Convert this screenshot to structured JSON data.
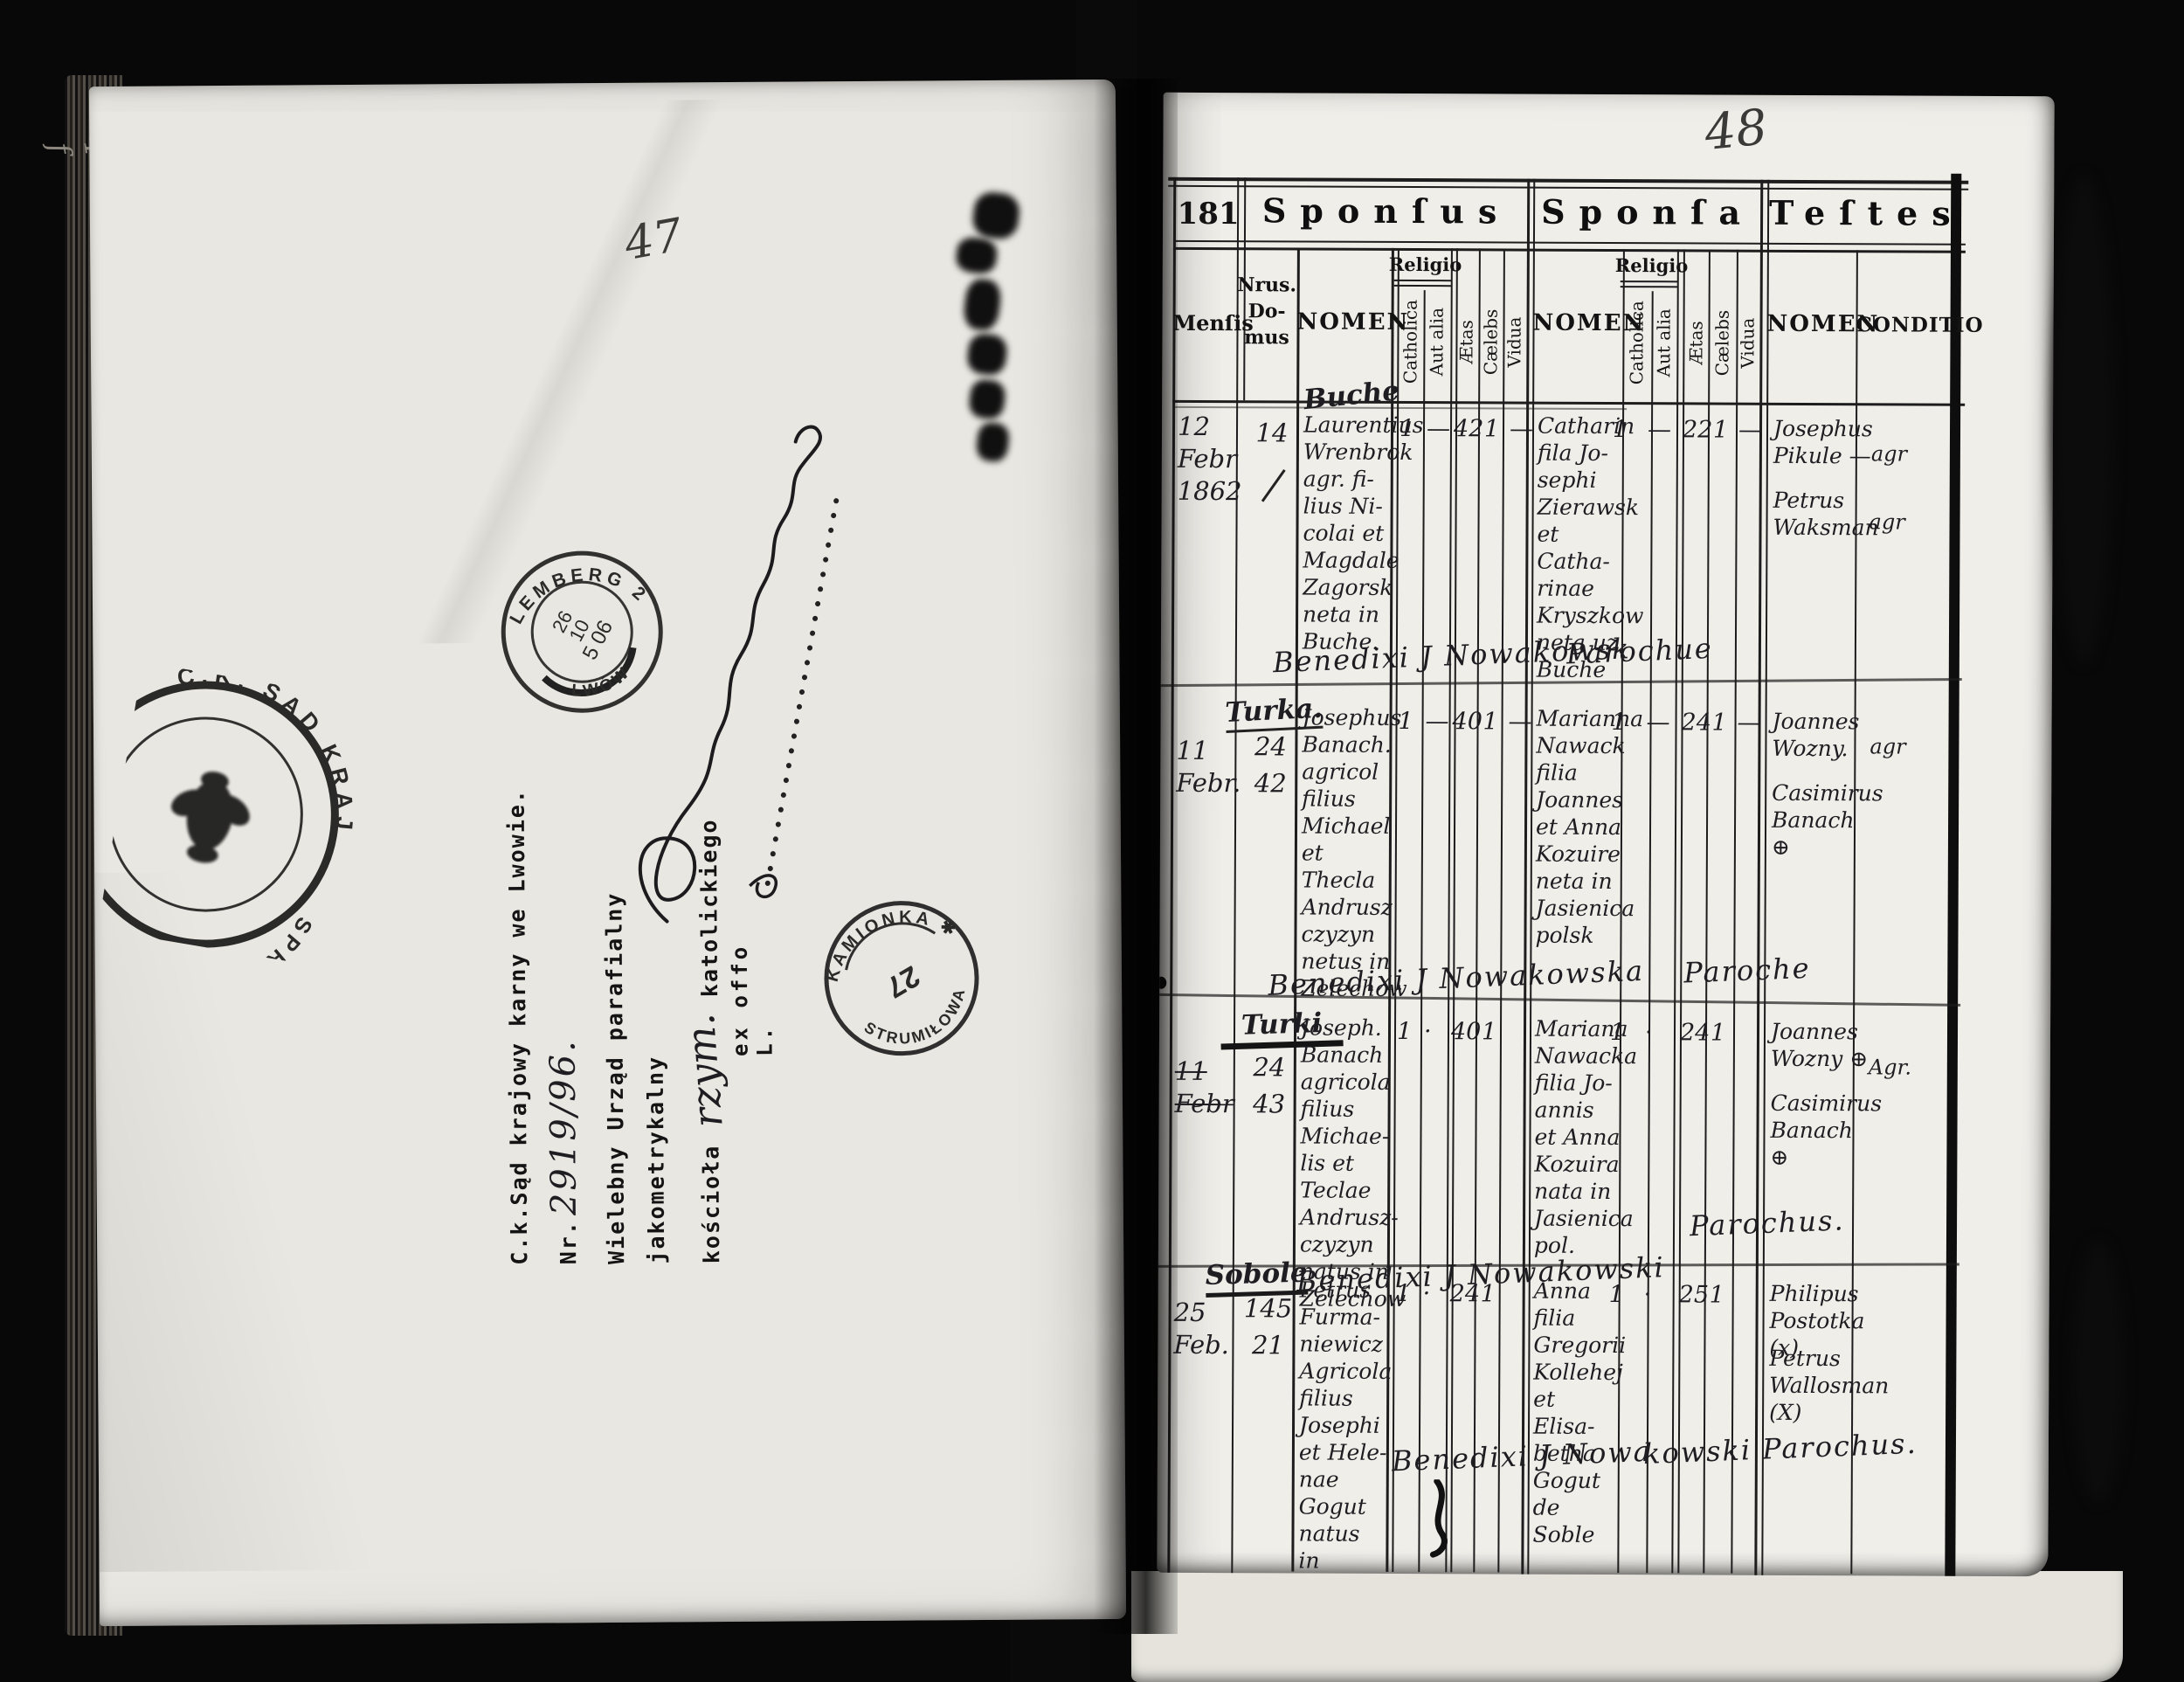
{
  "annotations": {
    "left_page_number": "47",
    "right_page_number": "48",
    "edge_mark": "4 f",
    "ex_offo": "ex offo L."
  },
  "left_page": {
    "court_letter": {
      "line1": "C.k.Sąd krajowy karny we Lwowie.",
      "line2_prefix": "Nr.",
      "line2_number": "2919/96.",
      "line3": "Wielebny Urząd parafialny jakometrykalny",
      "line4_prefix": "kościoła",
      "line4_inserted": "rzym.",
      "line4_suffix": "katolickiego"
    },
    "stamps": {
      "court_seal_arc_top": "C.K. SĄD KRAJ. W",
      "court_seal_arc_bottom": "SPRAW.",
      "lemberg_top": "LEMBERG 2",
      "lemberg_bottom": "LWÓW",
      "lemberg_date_l1": "26",
      "lemberg_date_l2": "10",
      "lemberg_date_l3": "5 06",
      "kamionka_top": "KAMIONKA ✱",
      "kamionka_bottom": "STRUMIŁOWA",
      "kamionka_center": "27"
    }
  },
  "right_page": {
    "folio": "181",
    "groups": {
      "sponsus": "Sponſus",
      "sponsa": "Sponſa",
      "testes": "Teſtes"
    },
    "columns": {
      "mensis": "Menſis",
      "nrus": "Nrus.\nDo-\nmus",
      "nomen": "NOMEN",
      "religio": "Religio",
      "catholica": "Catholica",
      "aut_alia": "Aut alia",
      "aetas": "Ætas",
      "caelebs": "Cælebs",
      "vidua": "Vidua",
      "nomen_sponsa": "NOMEN",
      "religio_sponsa": "Religio",
      "catholica_sponsa": "Catholica",
      "aut_alia_sponsa": "Aut alia",
      "aetas_sponsa": "Ætas",
      "caelebs_sponsa": "Cælebs",
      "vidua_sponsa": "Vidua",
      "nomen_testes": "NOMEN",
      "conditio": "CONDITIO"
    },
    "entries": [
      {
        "place": "Buche",
        "date": "12\nFebr\n1862",
        "nrus": "14",
        "sponsus": "Laurentius\nWrenbrok\nagr. fi-\nlius Ni-\ncolai et\nMagdale\nZagorsk\nneta in\nBuche.",
        "s_cath": "1",
        "s_aut": "—",
        "s_aetas": "42",
        "s_cael": "1",
        "s_vid": "—",
        "sponsa": "Catharin\nfila Jo-\nsephi\nZierawsk\net Catha-\nrinae\nKryszkow\nneta uz\nBuche",
        "a_cath": "1",
        "a_aut": "—",
        "a_aetas": "22",
        "a_cael": "1",
        "a_vid": "—",
        "testis1": "Josephus\nPikule —",
        "testis1_cond": "agr",
        "testis2": "Petrus\nWaksman",
        "testis2_cond": "agr",
        "bened1": "Benedixi J Nowakowsk",
        "bened2": "Parochue"
      },
      {
        "place": "Turka.",
        "date": "11\nFebr.",
        "nrus": "24\n42",
        "sponsus": "Josephus\nBanach.\nagricol\nfilius\nMichael\net Thecla\nAndrusz\nczyzyn\nnetus in\nZelechow",
        "s_cath": "1",
        "s_aut": "—",
        "s_aetas": "40",
        "s_cael": "1",
        "s_vid": "—",
        "sponsa": "Marianna\nNawack\nfilia\nJoannes\net Anna\nKozuire\nneta in\nJasienica\npolsk",
        "a_cath": "1",
        "a_aut": "—",
        "a_aetas": "24",
        "a_cael": "1",
        "a_vid": "—",
        "testis1": "Joannes\nWozny.",
        "testis1_cond": "agr",
        "testis2": "Casimirus\nBanach ⊕",
        "testis2_cond": "",
        "bened1": "Benedixi J Nowakowska",
        "bened2": "Paroche"
      },
      {
        "place": "Turki",
        "date": "11\nFebr",
        "nrus": "24\n43",
        "sponsus": "Joseph.\nBanach\nagricola\nfilius\nMichae-\nlis et\nTeclae\nAndrusz-\nczyzyn\nnatus in\nZelechow",
        "s_cath": "1",
        "s_aut": "·",
        "s_aetas": "40",
        "s_cael": "1",
        "s_vid": "",
        "sponsa": "Mariana\nNawacka\nfilia Jo-\nannis\net Anna\nKozuira\nnata in\nJasienica\npol.",
        "a_cath": "1",
        "a_aut": "·",
        "a_aetas": "24",
        "a_cael": "1",
        "a_vid": "",
        "testis1": "Joannes\nWozny ⊕",
        "testis1_cond": "Agr.",
        "testis2": "Casimirus\nBanach ⊕",
        "testis2_cond": "",
        "bened1": "Benedixi J Nowakowski",
        "bened2": "Parochus."
      },
      {
        "place": "Sobole",
        "date": "25\nFeb.",
        "nrus": "145\n21",
        "sponsus": "Petrus\nFurma-\nniewicz\nAgricola\nfilius\nJosephi\net Hele-\nnae Gogut\nnatus\nin Mazur-\nnia Wawr-\nkowa",
        "s_cath": "1",
        "s_aut": "·",
        "s_aetas": "24",
        "s_cael": "1",
        "s_vid": "",
        "sponsa": "Anna\nfilia\nGregorii\nKollehej\net Elisa-\nbetha\nGogut\nde Soble",
        "a_cath": "1",
        "a_aut": "·",
        "a_aetas": "25",
        "a_cael": "1",
        "a_vid": "",
        "testis1": "Philipus\nPostotka (x)",
        "testis1_cond": "",
        "testis2": "Petrus\nWallosman\n(X)",
        "testis2_cond": "",
        "bened1": "Benedixi J Nowa",
        "bened2": "kowski Parochus."
      }
    ]
  }
}
